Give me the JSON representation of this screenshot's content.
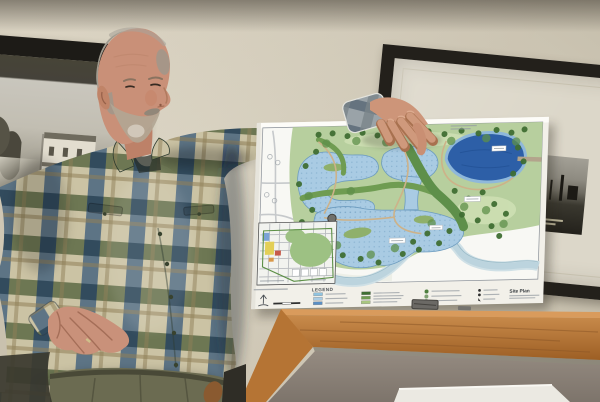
{
  "poster": {
    "legend": {
      "title": "LEGEND",
      "swatch_colors": [
        "#8fc3e0",
        "#aacde5",
        "#5b8fc4",
        "#3f6e33",
        "#6f9c52",
        "#a9c77f"
      ],
      "tree_symbol_color": "#4e7f3f",
      "site_symbol_color": "#2f2f2f"
    },
    "title_block": {
      "title": "Site Plan"
    },
    "map_colors": {
      "board": "#f2f0e9",
      "map_bg": "#f8f8f4",
      "grass": "#b7cf9e",
      "grass_light": "#cfe0b4",
      "pond": "#a9cbe3",
      "pond_edge": "#6d9cbf",
      "lake": "#2d5fa7",
      "lake_ring": "#8fb8da",
      "river": "#bcd4de",
      "sand": "#edefe7",
      "trail": "#cdb289",
      "tree_dark": "#3f6e33",
      "tree_light": "#5e8f4a"
    },
    "trees_dark": [
      [
        62,
        13
      ],
      [
        76,
        12
      ],
      [
        91,
        15
      ],
      [
        106,
        12
      ],
      [
        121,
        15
      ],
      [
        139,
        12
      ],
      [
        156,
        15
      ],
      [
        172,
        12
      ],
      [
        188,
        15
      ],
      [
        205,
        12
      ],
      [
        222,
        15
      ],
      [
        240,
        12
      ],
      [
        255,
        15
      ],
      [
        268,
        12
      ],
      [
        262,
        30
      ],
      [
        268,
        44
      ],
      [
        258,
        56
      ],
      [
        200,
        72
      ],
      [
        214,
        80
      ],
      [
        228,
        74
      ],
      [
        240,
        86
      ],
      [
        208,
        96
      ],
      [
        224,
        102
      ],
      [
        238,
        108
      ],
      [
        252,
        96
      ],
      [
        196,
        112
      ],
      [
        246,
        118
      ],
      [
        60,
        30
      ],
      [
        50,
        44
      ],
      [
        44,
        62
      ],
      [
        58,
        88
      ],
      [
        48,
        100
      ],
      [
        58,
        118
      ],
      [
        74,
        128
      ],
      [
        90,
        134
      ],
      [
        108,
        138
      ],
      [
        126,
        142
      ],
      [
        160,
        122
      ],
      [
        174,
        114
      ],
      [
        150,
        134
      ],
      [
        166,
        130
      ],
      [
        186,
        124
      ]
    ],
    "trees_light": [
      [
        70,
        22
      ],
      [
        100,
        20
      ],
      [
        130,
        22
      ],
      [
        165,
        20
      ],
      [
        195,
        22
      ],
      [
        230,
        20
      ],
      [
        260,
        24
      ],
      [
        210,
        88
      ],
      [
        232,
        92
      ],
      [
        68,
        112
      ],
      [
        84,
        124
      ],
      [
        118,
        134
      ],
      [
        142,
        128
      ],
      [
        178,
        104
      ],
      [
        250,
        106
      ],
      [
        54,
        74
      ],
      [
        96,
        70
      ]
    ],
    "west_markers": [
      [
        14,
        34
      ],
      [
        22,
        40
      ],
      [
        12,
        72
      ],
      [
        20,
        78
      ]
    ],
    "inset_colors": {
      "bg": "#f2f3ef",
      "park": "#9dc183",
      "yellow": "#e3cf56",
      "blue": "#7aa3d6",
      "red": "#c65a4a",
      "orange": "#d9984a"
    }
  },
  "room": {
    "wall": "#d6cebb",
    "frame": "#23201b",
    "mat": "#dcd7c9",
    "wood_rail": "#b5722f",
    "podium_body": "#8b8178",
    "paper_sheet": "#ebe9e2"
  },
  "person": {
    "skin": "#c99078",
    "hair": "#a19b8f",
    "beard": "#b2a694",
    "shirt_plaid": [
      "#cbc3a4",
      "#5d6a45",
      "#3e5d7c"
    ],
    "pants": "#6b6b51"
  }
}
